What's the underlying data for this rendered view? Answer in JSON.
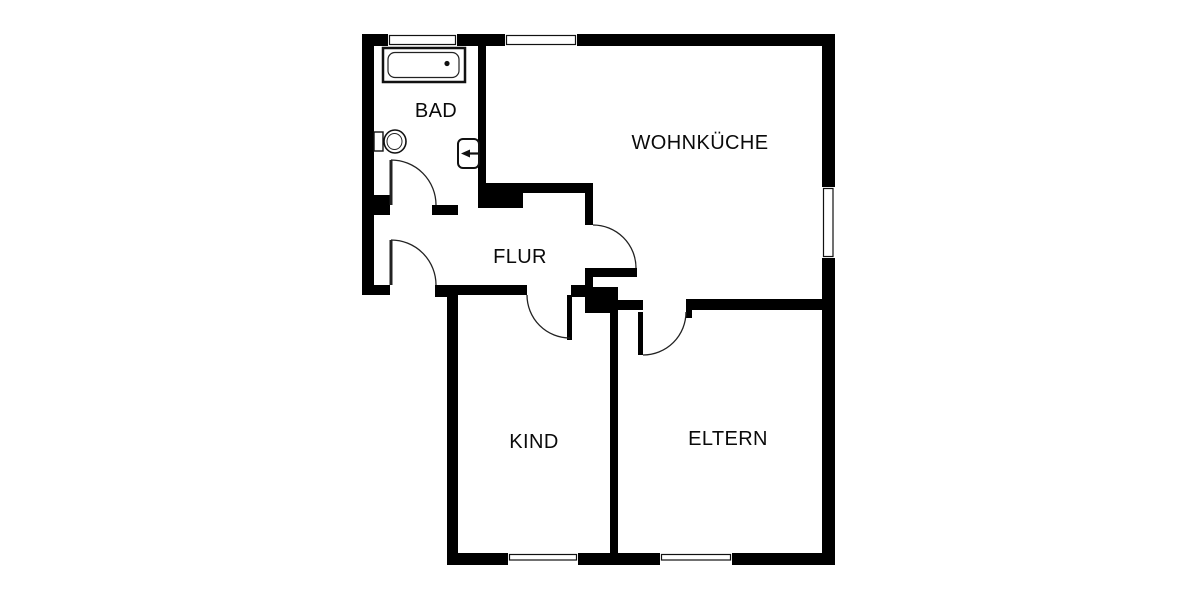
{
  "floorplan": {
    "type": "apartment-floor-plan",
    "rooms": {
      "bad": {
        "label": "BAD"
      },
      "wohnkueche": {
        "label": "WOHNKÜCHE"
      },
      "flur": {
        "label": "FLUR"
      },
      "kind": {
        "label": "KIND"
      },
      "eltern": {
        "label": "ELTERN"
      }
    },
    "fixtures": {
      "bathtub": "bathtub-icon",
      "toilet": "toilet-icon",
      "sink": "sink-icon"
    },
    "colors": {
      "wall": "#000000",
      "floor": "#ffffff",
      "line": "#222222"
    }
  }
}
